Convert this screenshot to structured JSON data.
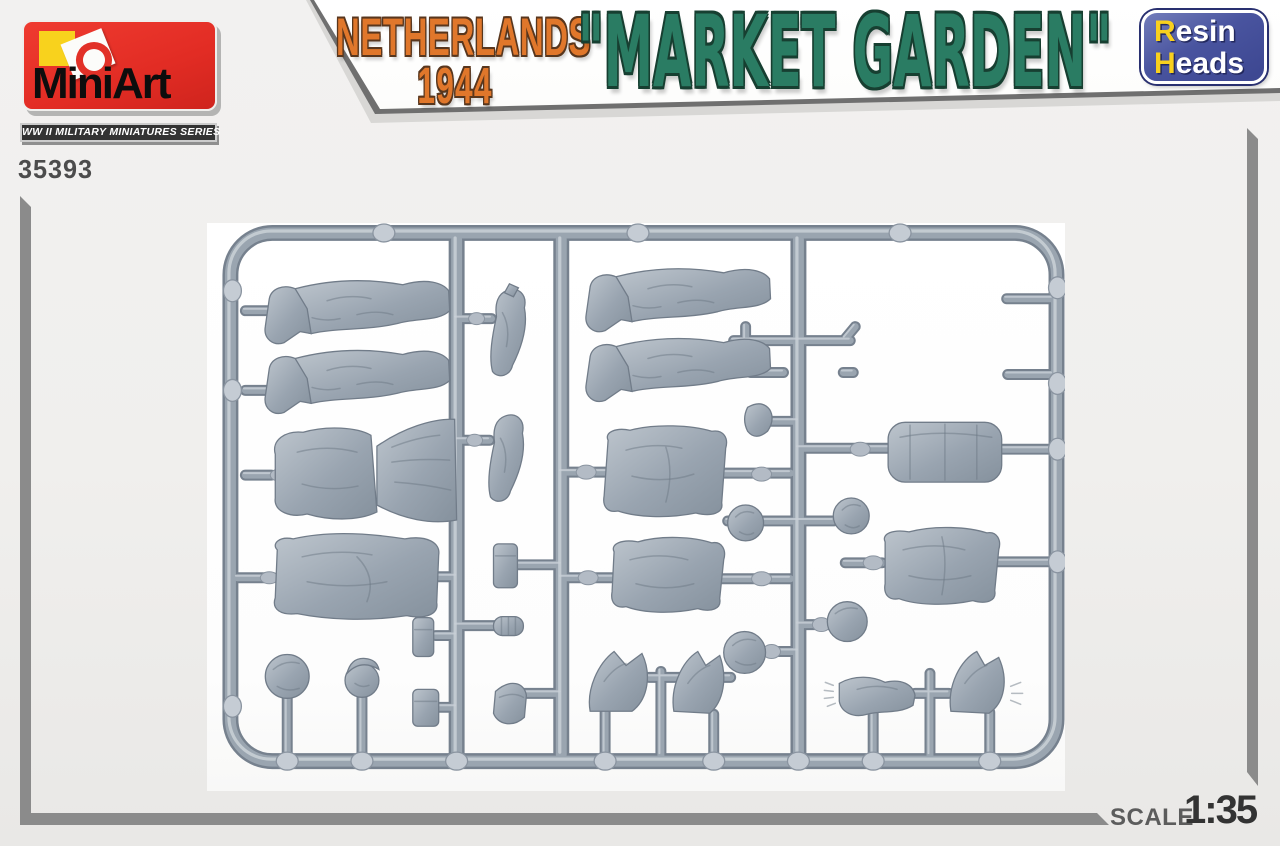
{
  "header": {
    "brand": "MiniArt",
    "series_bar": "WW II MILITARY MINIATURES SERIES",
    "kit_number": "35393",
    "title_line1": "NETHERLANDS",
    "title_line2": "1944",
    "title_main": "\"MARKET GARDEN\"",
    "badge": {
      "line1": "Resin",
      "line2": "Heads"
    }
  },
  "footer": {
    "scale_label": "SCALE",
    "scale_value": "1:35"
  },
  "colors": {
    "brand_red": "#e23128",
    "accent_yellow": "#f8d21d",
    "title_orange": "#e0772b",
    "title_teal": "#2a7c63",
    "badge_navy": "#414c96",
    "frame_gray": "#8b8b8b",
    "plastic_gray": "#9aa5b1",
    "photo_background": "#ffffff"
  },
  "sprue": {
    "description": "Single gray styrene sprue of 1/35 figure parts photographed on white",
    "visible_parts": [
      "six pairs of legs",
      "five torsos in camouflage smocks",
      "vertical arms",
      "four bent arms with hands",
      "heads",
      "helmet balls",
      "beret",
      "equipment pouches",
      "stick-grenade head",
      "rolled smock cylinder",
      "entrenching-tool cover"
    ]
  }
}
